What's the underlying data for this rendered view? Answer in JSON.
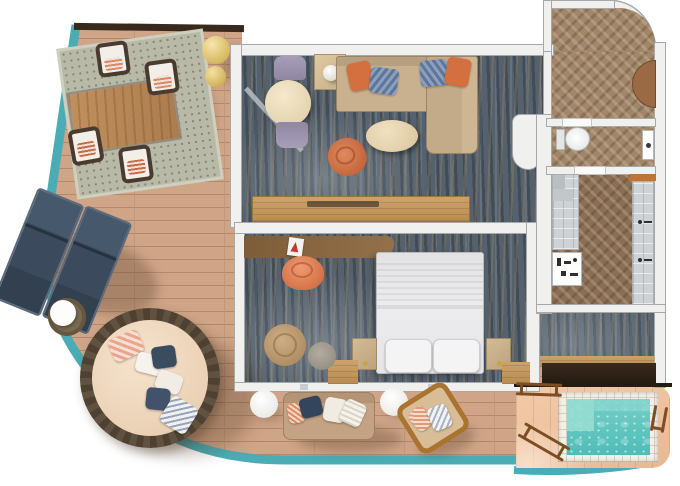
{
  "description": "Top-down 3D rendered floor plan of a cruise ship suite with wrap-around balcony and private whirlpool deck. No text is rendered in the image.",
  "palette": {
    "teal": "#4aacb4",
    "deck": "#cfa487",
    "poolDeck": "#eec3a2",
    "carpet": "#55616c",
    "herringbone": "#a1866a",
    "bathFloor": "#8a6f55",
    "wall": "#f0f1ef",
    "water": "#56c4be",
    "navy": "#3d4d60",
    "coral": "#d4703f",
    "tan": "#c6ab8a",
    "cream": "#e9d9b6",
    "wood": "#b8895c",
    "darkWall": "#38291c",
    "poolStep": "#97ddd3",
    "rattan": "#5d4e3e"
  },
  "labels": {
    "suite": "Suite floor plan",
    "balcony": "Wrap-around balcony deck",
    "edge": "Teal deck edge",
    "rug": "Outdoor rug",
    "diningTable": "Outdoor dining table",
    "diningChair": "Outdoor dining chair",
    "lamp": "Sphere floor lamp",
    "lounger": "Sun lounger",
    "sideTable": "Rattan side table",
    "daybed": "Round daybed",
    "pillow": "Throw pillow",
    "outdoorSofa": "Outdoor sofa",
    "whiteTable": "Round side table",
    "hangingChair": "Outdoor lounge chair",
    "living": "Living room",
    "sofa": "Sectional sofa",
    "chaise": "Chaise lounge",
    "lampTable": "Lamp table",
    "tableLamp": "Table lamp",
    "indoorDining": "Dining table",
    "indoorChair": "Dining chair",
    "accentChair": "Swivel armchair",
    "coffeeTable": "Oval coffee table",
    "console": "Media console",
    "doorLeaf": "Balcony door",
    "bedroom": "Bedroom",
    "desk": "Desk",
    "deskChair": "Desk chair",
    "book": "Book",
    "bed": "King bed",
    "bedPillow": "Bed pillow",
    "nightstand": "Nightstand",
    "bench": "Window bench",
    "pouf": "Pouf chair",
    "stool": "Side stool",
    "hall": "Entry hall",
    "door": "Entry door",
    "wc": "Guest WC",
    "toilet": "Toilet",
    "sink": "Washbasin",
    "bath": "Bathroom",
    "shower": "Shower",
    "vanity": "Vanity counter",
    "saunaBench": "Wood bench strip",
    "dressing": "Dressing area",
    "counter": "Dark vanity counter",
    "woodFloor": "Wood floor strip",
    "poolDeck": "Whirlpool deck",
    "pool": "Private whirlpool",
    "water": "Pool water",
    "poolStep": "Pool bench step",
    "ladder": "Pool ladder",
    "rail": "Grab rail",
    "wall": "Wall",
    "window": "Window wall",
    "shadow": "Cast shadow"
  },
  "rooms": [
    {
      "name": "Balcony",
      "items": [
        "dining table",
        "4 dining chairs",
        "outdoor rug",
        "2 sphere lamps",
        "2 sun loungers",
        "rattan side table",
        "round daybed with pillows",
        "outdoor sofa",
        "2 round side tables",
        "lounge chair"
      ]
    },
    {
      "name": "Living room",
      "items": [
        "sectional sofa with chaise",
        "orange and blue pillows",
        "round dining table",
        "2 purple chairs",
        "lamp table",
        "oval coffee table",
        "swivel armchair",
        "media console"
      ]
    },
    {
      "name": "Bedroom",
      "items": [
        "king bed",
        "2 nightstands",
        "desk",
        "coral desk chair",
        "book",
        "pouf",
        "stool",
        "window benches"
      ]
    },
    {
      "name": "Entry hall",
      "items": [
        "herringbone floor",
        "entry door"
      ]
    },
    {
      "name": "Guest WC",
      "items": [
        "toilet",
        "washbasin"
      ]
    },
    {
      "name": "Bathroom",
      "items": [
        "walk-in shower",
        "vanity with accessories",
        "second shower with controls"
      ]
    },
    {
      "name": "Dressing area",
      "items": [
        "dark counter",
        "carpet",
        "wood floor strip"
      ]
    },
    {
      "name": "Whirlpool deck",
      "items": [
        "plunge pool with tile surround",
        "2 ladders",
        "grab rail"
      ]
    }
  ]
}
